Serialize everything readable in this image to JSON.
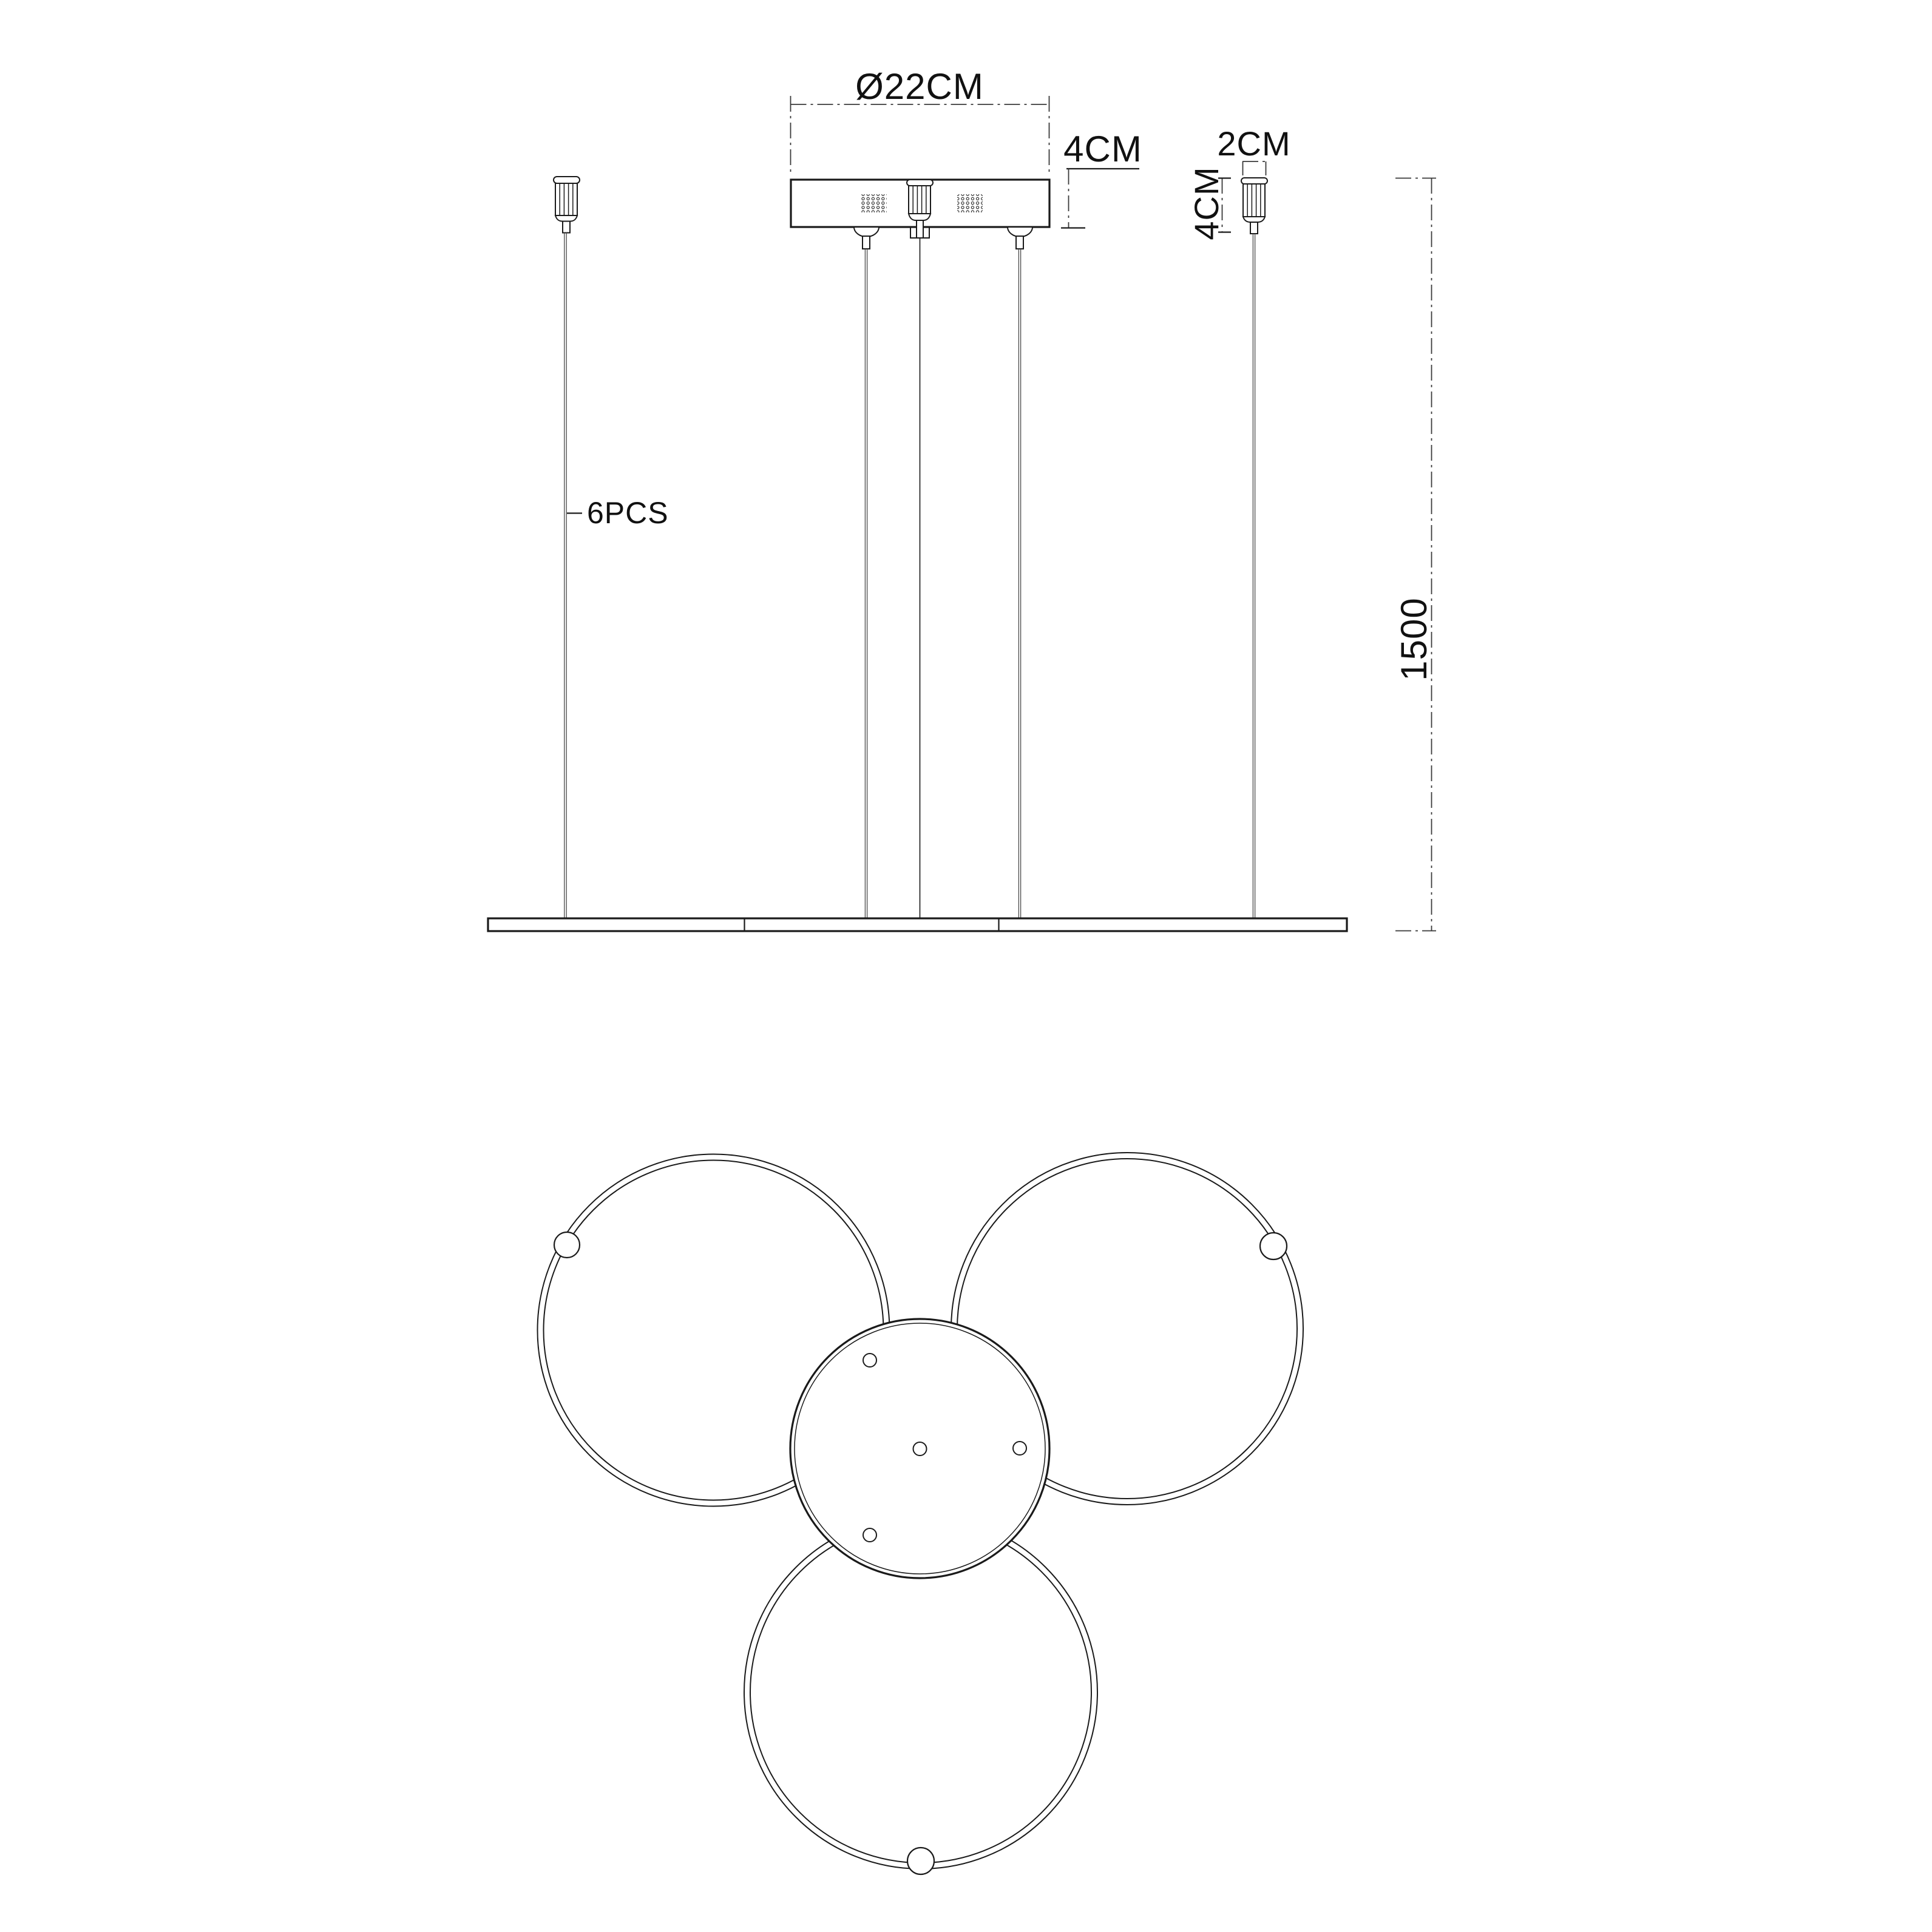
{
  "drawing": {
    "type": "pendant-lamp-technical-drawing",
    "colors": {
      "background": "#ffffff",
      "line": "#1a1a1a",
      "wire": "#4a4a4a",
      "dimension": "#3a3a3a"
    },
    "side_view": {
      "canopy_diameter_label": "Ø22CM",
      "canopy_height_label": "4CM",
      "cord_count_label": "6PCS",
      "gland_width_label": "2CM",
      "gland_height_label": "4CM",
      "drop_length_label": "1500"
    },
    "plan_view": {
      "ring_count": 3,
      "mount_hole_count": 4,
      "grommet_count": 3
    }
  }
}
